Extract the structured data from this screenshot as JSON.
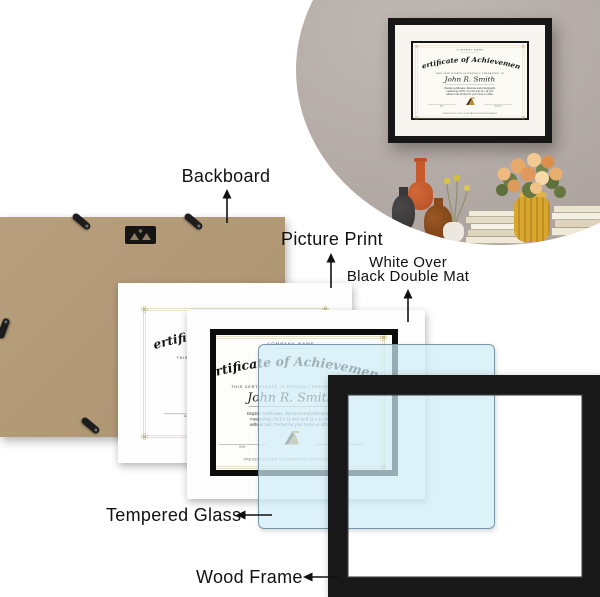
{
  "labels": {
    "backboard": "Backboard",
    "picture_print": "Picture Print",
    "double_mat_line1": "White Over",
    "double_mat_line2": "Black Double Mat",
    "tempered_glass": "Tempered Glass",
    "wood_frame": "Wood Frame"
  },
  "certificate": {
    "company": "COMPANY NAME",
    "title": "Certificate of Achievement",
    "presented": "THIS CERTIFICATE IS PROUDLY PRESENTED TO",
    "name": "John R. Smith",
    "body_lines": [
      "Display certificates, diplomas and photographs",
      "measuring of 8.5 x 11 inch and 11 x 14 inch",
      "without mat. Perfect for your home or office."
    ],
    "date_label": "Date",
    "signature_label": "Signature",
    "footer": "PRESENTED FOR OUTSTANDING ACHIEVEMENT"
  },
  "icons": {
    "sawtooth_hanger": "sawtooth-hanger-icon",
    "retainer_clip": "retainer-clip-icon",
    "gold_seal": "award-seal-icon",
    "corner_ornament": "floral-corner-ornament-icon",
    "up_arrow": "arrow-up-icon",
    "left_arrow": "arrow-left-icon"
  },
  "colors": {
    "backboard_kraft": "#b39b79",
    "glass_blue": "#d9edf6",
    "glass_edge": "#6a8898",
    "frame_black": "#181818",
    "mat_black": "#0c0c0c",
    "gold_border": "#cbbf95",
    "wall_taupe": "#b2a9a4",
    "vase_yellow": "#d8a52d",
    "flower_peach": "#e9a96a",
    "bottle_orange": "#c75a2d",
    "bottle_amber": "#8a4a1c"
  }
}
